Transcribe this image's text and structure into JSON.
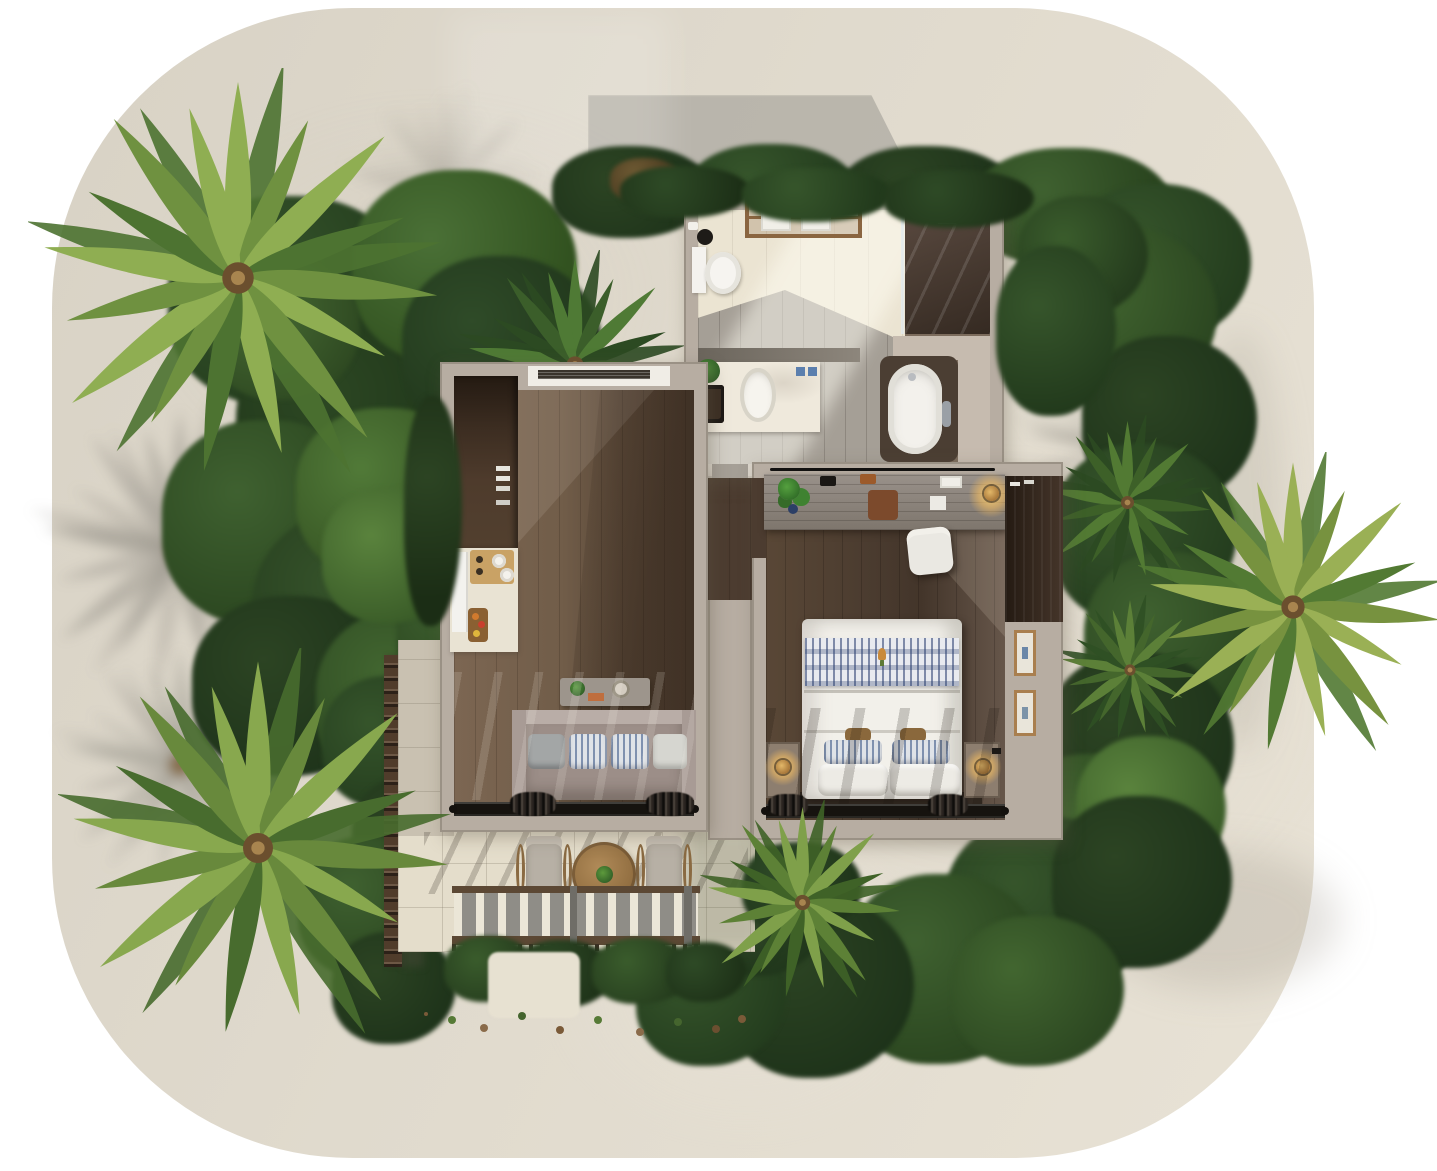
{
  "meta": {
    "type": "architectural-floor-plan-3d-render",
    "view": "top-down aerial",
    "subject": "one-bedroom tropical villa with garden, palm trees and terrace",
    "visible_text": "none"
  },
  "palette": {
    "background": "#ffffff",
    "sand": "#e0dacd",
    "building_shadow": "#949290",
    "wall": "#b7ada2",
    "foliage_dark": "#2c4423",
    "foliage_mid": "#3f6130",
    "foliage_light": "#5a833d",
    "palm_frond": "#8fae52",
    "wood_floor_living": "#6f5b47",
    "wood_floor_bedroom": "#4c3d31",
    "kitchen_cabinet": "#43332a",
    "counter_marble": "#e9e3d3",
    "bathroom_tile_light": "#ebe4d2",
    "bathroom_tile_grey": "#a59f96",
    "shower_dark": "#4a3b31",
    "tub_white": "#f3f1ec",
    "sofa": "#9c8e88",
    "cushion_blue": "#7189a2",
    "bed_white": "#f2f0ea",
    "throw_blue": "#3a5280",
    "lamp_glow": "#f6be60",
    "terrace_tile": "#e4ddcb",
    "pergola_slat": "#ebe6d7",
    "pergola_beam": "#5c4834",
    "privacy_screen": "#503c2b"
  },
  "scene": {
    "ground": {
      "label": "sand plot",
      "shape": "rounded-square"
    },
    "vegetation": {
      "large_palm_trees": 3,
      "accent_palms": 3,
      "garden_ring": true,
      "hedges": true
    },
    "rooms": [
      {
        "name": "bathroom",
        "fixtures": [
          "toilet",
          "waste-bin",
          "towel-rack",
          "walk-in-shower",
          "vanity-sink",
          "plant",
          "bathtub"
        ]
      },
      {
        "name": "living-kitchen",
        "features": [
          "air-vent",
          "kitchen-cabinets",
          "refrigerator",
          "cooktop",
          "fruit-basket",
          "console-table",
          "sofa",
          "sliding-glass-door",
          "curtains"
        ]
      },
      {
        "name": "bedroom",
        "features": [
          "desk",
          "desk-chair",
          "monstera-plant",
          "desk-lamp",
          "wardrobe",
          "picture-frames",
          "double-bed",
          "throw-blanket",
          "pillows",
          "nightstands",
          "bedside-lamps",
          "sliding-glass-door",
          "curtains"
        ]
      },
      {
        "name": "terrace",
        "features": [
          "lounge-chairs",
          "round-table",
          "pergola",
          "hedge",
          "privacy-screen",
          "sand-path"
        ]
      }
    ],
    "lighting": {
      "sun_direction": "upper-left",
      "shadows": [
        "building-shadow-top",
        "palm-shadows",
        "pergola-stripe-shadows",
        "interior-diagonal-light"
      ]
    },
    "counts": {
      "sofa_cushions": 4,
      "bed_pillows": 6,
      "picture_frames": 2,
      "lounge_chairs": 2,
      "towels_on_rack": 2
    }
  }
}
